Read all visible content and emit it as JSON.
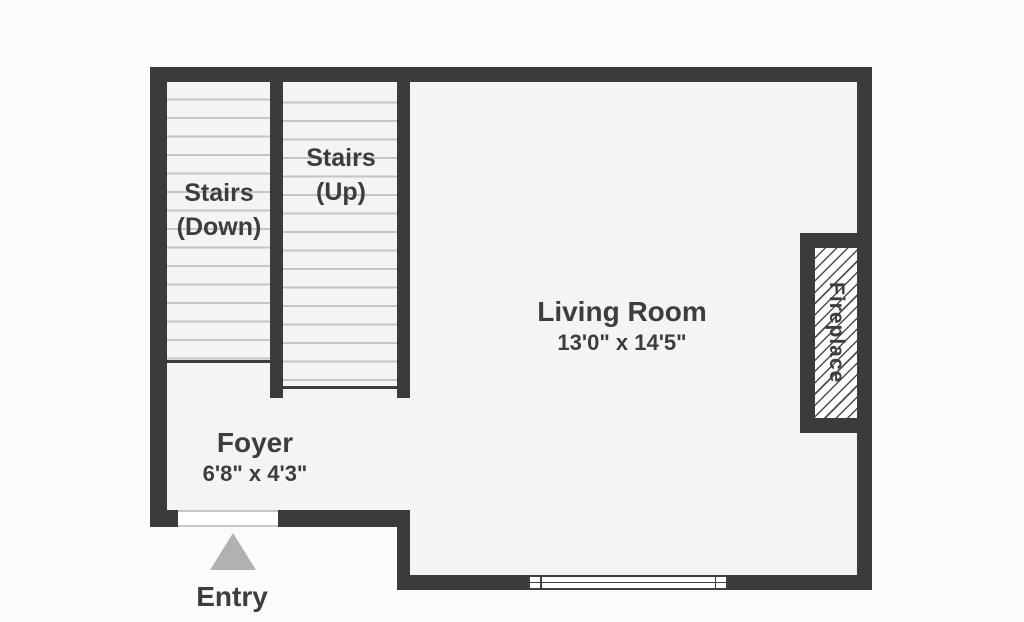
{
  "plan_title": "floor-plan",
  "colors": {
    "wall": "#3b3b3b",
    "floor": "#f4f4f4",
    "bg": "#fbfbfb",
    "tread": "#c5c5c5",
    "text": "#3d3d3d",
    "arrow": "#b1b1b1",
    "hatch": "#4e4e4e"
  },
  "rooms": {
    "stairs_down": {
      "label_line1": "Stairs",
      "label_line2": "(Down)"
    },
    "stairs_up": {
      "label_line1": "Stairs",
      "label_line2": "(Up)"
    },
    "living_room": {
      "name": "Living Room",
      "dimensions": "13'0\" x 14'5\""
    },
    "foyer": {
      "name": "Foyer",
      "dimensions": "6'8\" x 4'3\""
    },
    "fireplace": {
      "name": "Fireplace"
    },
    "entry": {
      "label": "Entry"
    }
  }
}
